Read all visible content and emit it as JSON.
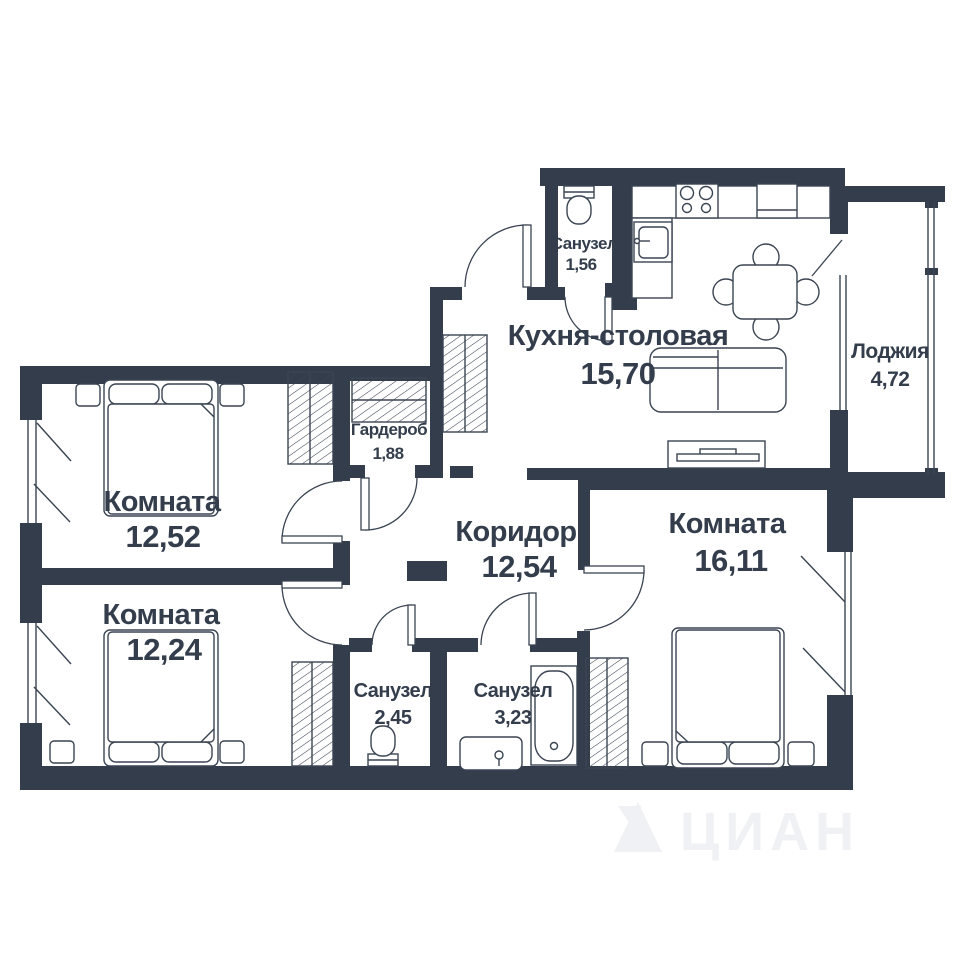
{
  "plan": {
    "type": "apartment-floor-plan",
    "rooms": {
      "kitchen": {
        "name": "Кухня-столовая",
        "area": "15,70"
      },
      "loggia": {
        "name": "Лоджия",
        "area": "4,72"
      },
      "bedroom1": {
        "name": "Комната",
        "area": "12,52"
      },
      "bedroom2": {
        "name": "Комната",
        "area": "12,24"
      },
      "bedroom3": {
        "name": "Комната",
        "area": "16,11"
      },
      "corridor": {
        "name": "Коридор",
        "area": "12,54"
      },
      "wardrobe": {
        "name": "Гардероб",
        "area": "1,88"
      },
      "wc1": {
        "name": "Санузел",
        "area": "1,56"
      },
      "wc2": {
        "name": "Санузел",
        "area": "2,45"
      },
      "wc3": {
        "name": "Санузел",
        "area": "3,23"
      }
    },
    "colors": {
      "wall": "#333d4b",
      "line": "#3a4452",
      "background": "#ffffff",
      "label": "#333d4b",
      "watermark": "#f0f1f4"
    },
    "watermark_text": "ЦИАН"
  }
}
